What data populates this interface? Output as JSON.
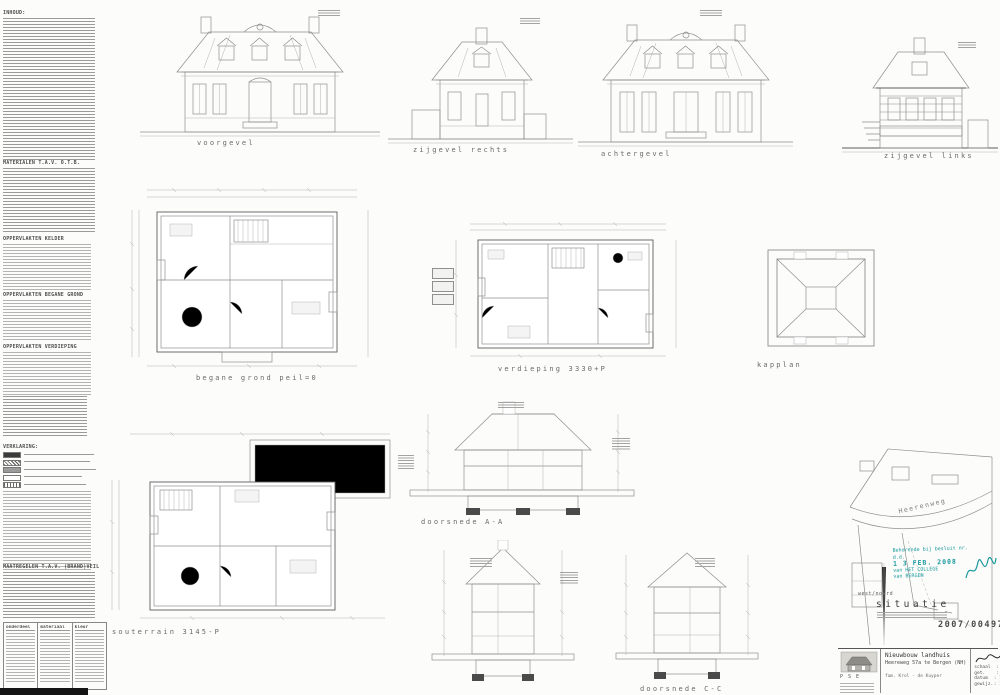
{
  "left_column": {
    "inhoud_heading": "INHOUD:",
    "materialen_heading": "MATERIALEN T.A.V. O.T.B.",
    "opp_kelder_heading": "OPPERVLAKTEN KELDER",
    "opp_bg_heading": "OPPERVLAKTEN BEGANE GROND",
    "opp_verd_heading": "OPPERVLAKTEN VERDIEPING",
    "verklaring_heading": "VERKLARING:",
    "maatregelen_heading": "MAATREGELEN T.A.V. (BRAND)VEILIGHEID",
    "table": {
      "headers": [
        "onderdeel",
        "materiaal",
        "kleur"
      ]
    }
  },
  "drawings": {
    "voorgevel": "voorgevel",
    "zijgevel_rechts": "zijgevel rechts",
    "achtergevel": "achtergevel",
    "zijgevel_links": "zijgevel links",
    "begane_grond": "begane grond peil=0",
    "verdieping": "verdieping 3330+P",
    "kapplan": "kapplan",
    "souterrain": "souterrain 3145-P",
    "doorsnede_aa": "doorsnede A-A",
    "doorsnede_cc": "doorsnede C-C"
  },
  "situatie": {
    "label": "situatie",
    "street": "Heerenweg",
    "direction": "west/noord",
    "stamp_number": "2007/00497",
    "approval": {
      "line1": "Behorende bij besluit nr.",
      "line2": "d.d.",
      "date": "1 3 FEB. 2008",
      "line3": "van HET COLLEGE",
      "line4": "van BERGEN"
    }
  },
  "titleblock": {
    "project": "Nieuwbouw landhuis",
    "address": "Heereweg 57a te Bergen (NH)",
    "client": "fam. Krol - de Kuyper",
    "logo": "P S E",
    "fields": [
      {
        "label": "schaal",
        "value": ": 1:100"
      },
      {
        "label": "get.",
        "value": ": B.K.B."
      },
      {
        "label": "datum",
        "value": ": 17-11-2007"
      },
      {
        "label": "gewijz.",
        "value": ": 13-02-2008"
      }
    ]
  }
}
